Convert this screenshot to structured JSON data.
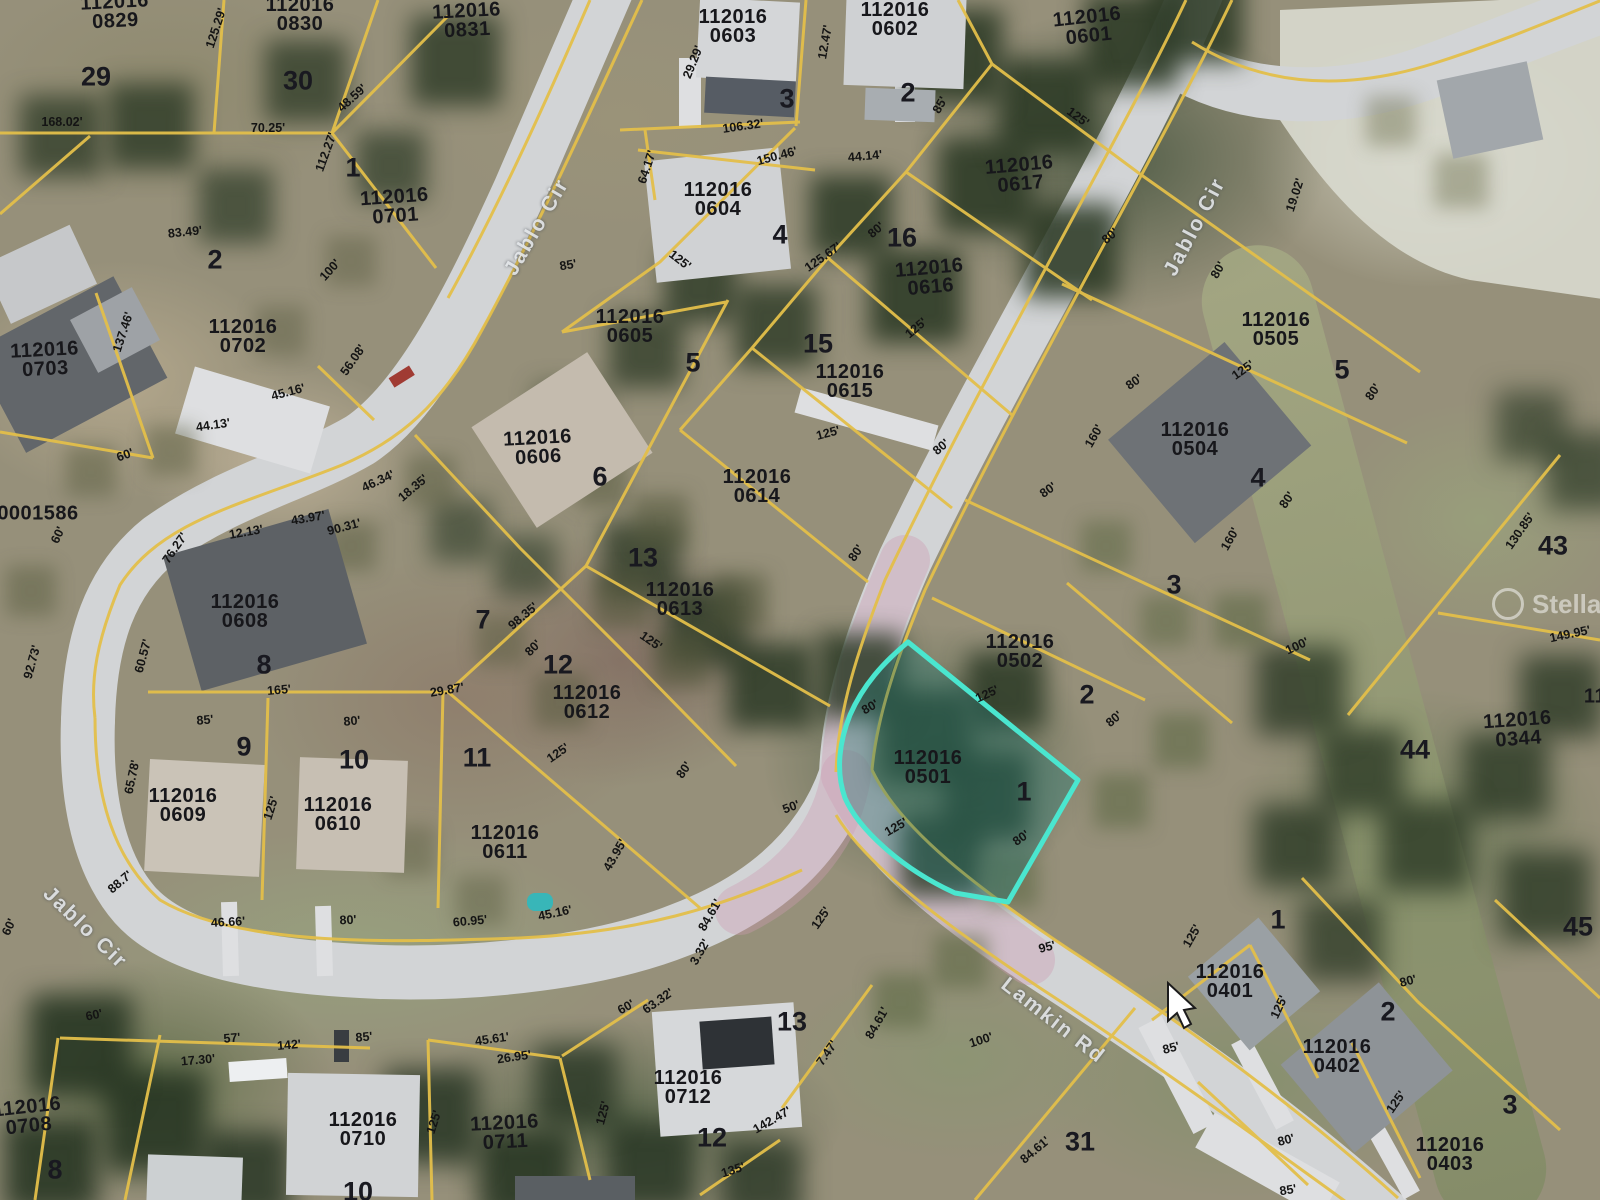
{
  "map": {
    "watermark": {
      "text": "Stellar MLS"
    },
    "highlight": {
      "parcel_id": "112016 0501",
      "color": "#4ae6cf"
    },
    "colors": {
      "parcel_line": "#e3bf4a",
      "road": "#d2d4d6",
      "highlight_fill": "rgba(38,120,115,0.4)"
    },
    "streets": [
      {
        "text": "Jablo Cir",
        "x": 537,
        "y": 227,
        "rot": -60
      },
      {
        "text": "Jablo Cir",
        "x": 1195,
        "y": 227,
        "rot": -62
      },
      {
        "text": "Jablo Cir",
        "x": 85,
        "y": 928,
        "rot": 44
      },
      {
        "text": "Lamkin Rd",
        "x": 1053,
        "y": 1021,
        "rot": 38
      }
    ],
    "parcel_labels": [
      {
        "text": "112016\n0829",
        "x": 115,
        "y": 12,
        "rot": -3
      },
      {
        "text": "112016\n0830",
        "x": 300,
        "y": 15,
        "rot": 0
      },
      {
        "text": "112016\n0831",
        "x": 467,
        "y": 21,
        "rot": -3
      },
      {
        "text": "112016\n0701",
        "x": 395,
        "y": 207,
        "rot": -4
      },
      {
        "text": "112016\n0702",
        "x": 243,
        "y": 337,
        "rot": 0
      },
      {
        "text": "112016\n0703",
        "x": 45,
        "y": 360,
        "rot": -3
      },
      {
        "text": "0001586",
        "x": 38,
        "y": 514,
        "rot": 0
      },
      {
        "text": "112016\n0603",
        "x": 733,
        "y": 27,
        "rot": 0
      },
      {
        "text": "112016\n0602",
        "x": 895,
        "y": 20,
        "rot": 0
      },
      {
        "text": "112016\n0601",
        "x": 1088,
        "y": 27,
        "rot": -6
      },
      {
        "text": "112016\n0604",
        "x": 718,
        "y": 200,
        "rot": 0
      },
      {
        "text": "112016\n0605",
        "x": 630,
        "y": 327,
        "rot": 0
      },
      {
        "text": "112016\n0606",
        "x": 538,
        "y": 448,
        "rot": -3
      },
      {
        "text": "112016\n0608",
        "x": 245,
        "y": 612,
        "rot": 0
      },
      {
        "text": "112016\n0609",
        "x": 183,
        "y": 806,
        "rot": 0
      },
      {
        "text": "112016\n0610",
        "x": 338,
        "y": 815,
        "rot": 0
      },
      {
        "text": "112016\n0611",
        "x": 505,
        "y": 843,
        "rot": 0
      },
      {
        "text": "112016\n0612",
        "x": 587,
        "y": 703,
        "rot": 0
      },
      {
        "text": "112016\n0613",
        "x": 680,
        "y": 600,
        "rot": 0
      },
      {
        "text": "112016\n0614",
        "x": 757,
        "y": 487,
        "rot": 0
      },
      {
        "text": "112016\n0615",
        "x": 850,
        "y": 382,
        "rot": 0
      },
      {
        "text": "112016\n0616",
        "x": 930,
        "y": 278,
        "rot": -5
      },
      {
        "text": "112016\n0617",
        "x": 1020,
        "y": 175,
        "rot": -5
      },
      {
        "text": "112016\n0504",
        "x": 1195,
        "y": 440,
        "rot": 0
      },
      {
        "text": "112016\n0505",
        "x": 1276,
        "y": 330,
        "rot": 0
      },
      {
        "text": "112016\n0502",
        "x": 1020,
        "y": 652,
        "rot": 0
      },
      {
        "text": "112016\n0501",
        "x": 928,
        "y": 768,
        "rot": 0
      },
      {
        "text": "112016\n0401",
        "x": 1230,
        "y": 982,
        "rot": 0
      },
      {
        "text": "112016\n0402",
        "x": 1337,
        "y": 1057,
        "rot": 0
      },
      {
        "text": "112016\n0403",
        "x": 1450,
        "y": 1155,
        "rot": 0
      },
      {
        "text": "112016\n0344",
        "x": 1518,
        "y": 730,
        "rot": -4
      },
      {
        "text": "112016\n0708",
        "x": 28,
        "y": 1117,
        "rot": -6
      },
      {
        "text": "112016\n0710",
        "x": 363,
        "y": 1130,
        "rot": 0
      },
      {
        "text": "112016\n0711",
        "x": 505,
        "y": 1133,
        "rot": -3
      },
      {
        "text": "112016\n0712",
        "x": 688,
        "y": 1088,
        "rot": 0
      },
      {
        "text": "11",
        "x": 1595,
        "y": 697,
        "rot": 0
      }
    ],
    "lot_numbers": [
      {
        "text": "29",
        "x": 96,
        "y": 77,
        "rot": 0
      },
      {
        "text": "30",
        "x": 298,
        "y": 81,
        "rot": 0
      },
      {
        "text": "1",
        "x": 353,
        "y": 168,
        "rot": 0
      },
      {
        "text": "2",
        "x": 215,
        "y": 260,
        "rot": 0
      },
      {
        "text": "3",
        "x": 787,
        "y": 99,
        "rot": 0
      },
      {
        "text": "2",
        "x": 908,
        "y": 93,
        "rot": 0
      },
      {
        "text": "4",
        "x": 780,
        "y": 235,
        "rot": 0
      },
      {
        "text": "5",
        "x": 693,
        "y": 363,
        "rot": 0
      },
      {
        "text": "6",
        "x": 600,
        "y": 477,
        "rot": 0
      },
      {
        "text": "16",
        "x": 902,
        "y": 238,
        "rot": 0
      },
      {
        "text": "15",
        "x": 818,
        "y": 344,
        "rot": 0
      },
      {
        "text": "13",
        "x": 643,
        "y": 558,
        "rot": 0
      },
      {
        "text": "4",
        "x": 1258,
        "y": 478,
        "rot": 0
      },
      {
        "text": "5",
        "x": 1342,
        "y": 370,
        "rot": 0
      },
      {
        "text": "3",
        "x": 1174,
        "y": 585,
        "rot": 0
      },
      {
        "text": "2",
        "x": 1087,
        "y": 695,
        "rot": 0
      },
      {
        "text": "1",
        "x": 1024,
        "y": 792,
        "rot": 0
      },
      {
        "text": "8",
        "x": 264,
        "y": 665,
        "rot": 0
      },
      {
        "text": "9",
        "x": 244,
        "y": 747,
        "rot": 0
      },
      {
        "text": "10",
        "x": 354,
        "y": 760,
        "rot": 0
      },
      {
        "text": "7",
        "x": 483,
        "y": 620,
        "rot": 0
      },
      {
        "text": "12",
        "x": 558,
        "y": 665,
        "rot": 0
      },
      {
        "text": "11",
        "x": 477,
        "y": 758,
        "rot": 0
      },
      {
        "text": "44",
        "x": 1415,
        "y": 750,
        "rot": 0
      },
      {
        "text": "43",
        "x": 1553,
        "y": 546,
        "rot": 0
      },
      {
        "text": "31",
        "x": 1080,
        "y": 1142,
        "rot": 0
      },
      {
        "text": "12",
        "x": 712,
        "y": 1138,
        "rot": 0
      },
      {
        "text": "13",
        "x": 792,
        "y": 1022,
        "rot": 0
      },
      {
        "text": "10",
        "x": 358,
        "y": 1192,
        "rot": 0
      },
      {
        "text": "8",
        "x": 55,
        "y": 1170,
        "rot": 0
      },
      {
        "text": "2",
        "x": 1388,
        "y": 1012,
        "rot": 0
      },
      {
        "text": "1",
        "x": 1278,
        "y": 920,
        "rot": 0
      },
      {
        "text": "3",
        "x": 1510,
        "y": 1105,
        "rot": 0
      },
      {
        "text": "45",
        "x": 1578,
        "y": 927,
        "rot": 0
      }
    ],
    "dimensions": [
      {
        "text": "168.02'",
        "x": 62,
        "y": 122,
        "rot": 0
      },
      {
        "text": "70.25'",
        "x": 268,
        "y": 128,
        "rot": 0
      },
      {
        "text": "125.29'",
        "x": 216,
        "y": 28,
        "rot": -72
      },
      {
        "text": "48.59'",
        "x": 352,
        "y": 98,
        "rot": -42
      },
      {
        "text": "112.27'",
        "x": 326,
        "y": 152,
        "rot": -70
      },
      {
        "text": "83.49'",
        "x": 185,
        "y": 232,
        "rot": -6
      },
      {
        "text": "100'",
        "x": 330,
        "y": 270,
        "rot": -48
      },
      {
        "text": "137.46'",
        "x": 123,
        "y": 332,
        "rot": -72
      },
      {
        "text": "56.08'",
        "x": 353,
        "y": 360,
        "rot": -55
      },
      {
        "text": "45.16'",
        "x": 288,
        "y": 392,
        "rot": -15
      },
      {
        "text": "44.13'",
        "x": 213,
        "y": 425,
        "rot": -8
      },
      {
        "text": "60'",
        "x": 125,
        "y": 455,
        "rot": -20
      },
      {
        "text": "60'",
        "x": 58,
        "y": 535,
        "rot": -65
      },
      {
        "text": "46.34'",
        "x": 378,
        "y": 481,
        "rot": -25
      },
      {
        "text": "12.13'",
        "x": 246,
        "y": 532,
        "rot": -10
      },
      {
        "text": "76.27'",
        "x": 175,
        "y": 548,
        "rot": -55
      },
      {
        "text": "43.97'",
        "x": 308,
        "y": 518,
        "rot": -10
      },
      {
        "text": "90.31'",
        "x": 344,
        "y": 527,
        "rot": -15
      },
      {
        "text": "18.35'",
        "x": 413,
        "y": 488,
        "rot": -40
      },
      {
        "text": "85'",
        "x": 568,
        "y": 265,
        "rot": -10
      },
      {
        "text": "125'",
        "x": 680,
        "y": 260,
        "rot": 38
      },
      {
        "text": "106.32'",
        "x": 743,
        "y": 126,
        "rot": -8
      },
      {
        "text": "150.46'",
        "x": 777,
        "y": 156,
        "rot": -15
      },
      {
        "text": "64.17'",
        "x": 647,
        "y": 167,
        "rot": -72
      },
      {
        "text": "29.29'",
        "x": 693,
        "y": 62,
        "rot": -68
      },
      {
        "text": "12.47'",
        "x": 825,
        "y": 42,
        "rot": -80
      },
      {
        "text": "44.14'",
        "x": 865,
        "y": 156,
        "rot": -5
      },
      {
        "text": "125'",
        "x": 1078,
        "y": 117,
        "rot": 36
      },
      {
        "text": "85'",
        "x": 940,
        "y": 105,
        "rot": -60
      },
      {
        "text": "125.67'",
        "x": 823,
        "y": 257,
        "rot": -35
      },
      {
        "text": "80'",
        "x": 876,
        "y": 230,
        "rot": -40
      },
      {
        "text": "125'",
        "x": 916,
        "y": 328,
        "rot": -40
      },
      {
        "text": "80'",
        "x": 941,
        "y": 447,
        "rot": -40
      },
      {
        "text": "125'",
        "x": 828,
        "y": 433,
        "rot": -15
      },
      {
        "text": "80'",
        "x": 856,
        "y": 553,
        "rot": -55
      },
      {
        "text": "160'",
        "x": 1094,
        "y": 436,
        "rot": -60
      },
      {
        "text": "80'",
        "x": 1134,
        "y": 382,
        "rot": -35
      },
      {
        "text": "80'",
        "x": 1048,
        "y": 490,
        "rot": -35
      },
      {
        "text": "80'",
        "x": 1110,
        "y": 236,
        "rot": -40
      },
      {
        "text": "19.02'",
        "x": 1295,
        "y": 195,
        "rot": -72
      },
      {
        "text": "80'",
        "x": 1218,
        "y": 270,
        "rot": -60
      },
      {
        "text": "125'",
        "x": 1243,
        "y": 370,
        "rot": -35
      },
      {
        "text": "80'",
        "x": 1373,
        "y": 392,
        "rot": -55
      },
      {
        "text": "80'",
        "x": 1287,
        "y": 500,
        "rot": -55
      },
      {
        "text": "160'",
        "x": 1230,
        "y": 539,
        "rot": -60
      },
      {
        "text": "130.85'",
        "x": 1520,
        "y": 531,
        "rot": -55
      },
      {
        "text": "149.95'",
        "x": 1570,
        "y": 634,
        "rot": -12
      },
      {
        "text": "100'",
        "x": 1297,
        "y": 646,
        "rot": -25
      },
      {
        "text": "92.73'",
        "x": 32,
        "y": 662,
        "rot": -75
      },
      {
        "text": "60.57'",
        "x": 143,
        "y": 656,
        "rot": -75
      },
      {
        "text": "165'",
        "x": 279,
        "y": 690,
        "rot": -5
      },
      {
        "text": "85'",
        "x": 205,
        "y": 720,
        "rot": -5
      },
      {
        "text": "80'",
        "x": 352,
        "y": 721,
        "rot": -5
      },
      {
        "text": "65.78'",
        "x": 132,
        "y": 777,
        "rot": -78
      },
      {
        "text": "125'",
        "x": 271,
        "y": 808,
        "rot": -72
      },
      {
        "text": "88.7'",
        "x": 120,
        "y": 882,
        "rot": -40
      },
      {
        "text": "98.35'",
        "x": 523,
        "y": 616,
        "rot": -40
      },
      {
        "text": "80'",
        "x": 533,
        "y": 648,
        "rot": -45
      },
      {
        "text": "29.87'",
        "x": 447,
        "y": 690,
        "rot": -10
      },
      {
        "text": "125'",
        "x": 651,
        "y": 641,
        "rot": 35
      },
      {
        "text": "125'",
        "x": 558,
        "y": 753,
        "rot": -35
      },
      {
        "text": "80'",
        "x": 684,
        "y": 770,
        "rot": -55
      },
      {
        "text": "43.95'",
        "x": 615,
        "y": 855,
        "rot": -60
      },
      {
        "text": "50'",
        "x": 791,
        "y": 807,
        "rot": -20
      },
      {
        "text": "80'",
        "x": 870,
        "y": 707,
        "rot": -30
      },
      {
        "text": "125'",
        "x": 987,
        "y": 694,
        "rot": -25
      },
      {
        "text": "80'",
        "x": 1114,
        "y": 719,
        "rot": -40
      },
      {
        "text": "125'",
        "x": 896,
        "y": 827,
        "rot": -30
      },
      {
        "text": "80'",
        "x": 1021,
        "y": 838,
        "rot": -35
      },
      {
        "text": "46.66'",
        "x": 228,
        "y": 922,
        "rot": -3
      },
      {
        "text": "80'",
        "x": 348,
        "y": 920,
        "rot": -3
      },
      {
        "text": "60'",
        "x": 9,
        "y": 927,
        "rot": -65
      },
      {
        "text": "60'",
        "x": 94,
        "y": 1015,
        "rot": -12
      },
      {
        "text": "57'",
        "x": 232,
        "y": 1038,
        "rot": -5
      },
      {
        "text": "142'",
        "x": 289,
        "y": 1045,
        "rot": -5
      },
      {
        "text": "17.30'",
        "x": 198,
        "y": 1060,
        "rot": -5
      },
      {
        "text": "85'",
        "x": 364,
        "y": 1037,
        "rot": -5
      },
      {
        "text": "60.95'",
        "x": 470,
        "y": 921,
        "rot": -5
      },
      {
        "text": "45.16'",
        "x": 555,
        "y": 913,
        "rot": -12
      },
      {
        "text": "45.61'",
        "x": 492,
        "y": 1039,
        "rot": -8
      },
      {
        "text": "26.95'",
        "x": 514,
        "y": 1057,
        "rot": -8
      },
      {
        "text": "63.32'",
        "x": 658,
        "y": 1001,
        "rot": -35
      },
      {
        "text": "60'",
        "x": 626,
        "y": 1007,
        "rot": -30
      },
      {
        "text": "3.32'",
        "x": 700,
        "y": 952,
        "rot": -60
      },
      {
        "text": "84.61'",
        "x": 710,
        "y": 915,
        "rot": -60
      },
      {
        "text": "125'",
        "x": 434,
        "y": 1122,
        "rot": -72
      },
      {
        "text": "125'",
        "x": 603,
        "y": 1113,
        "rot": -75
      },
      {
        "text": "135'",
        "x": 733,
        "y": 1170,
        "rot": -18
      },
      {
        "text": "142.47'",
        "x": 772,
        "y": 1120,
        "rot": -30
      },
      {
        "text": "95'",
        "x": 1047,
        "y": 947,
        "rot": -15
      },
      {
        "text": "100'",
        "x": 981,
        "y": 1040,
        "rot": -18
      },
      {
        "text": "84.61'",
        "x": 1035,
        "y": 1150,
        "rot": -40
      },
      {
        "text": "7.47'",
        "x": 827,
        "y": 1053,
        "rot": -55
      },
      {
        "text": "84.61'",
        "x": 877,
        "y": 1023,
        "rot": -60
      },
      {
        "text": "125'",
        "x": 821,
        "y": 918,
        "rot": -55
      },
      {
        "text": "125'",
        "x": 1192,
        "y": 936,
        "rot": -60
      },
      {
        "text": "85'",
        "x": 1171,
        "y": 1048,
        "rot": -15
      },
      {
        "text": "125'",
        "x": 1279,
        "y": 1007,
        "rot": -65
      },
      {
        "text": "80'",
        "x": 1408,
        "y": 981,
        "rot": -15
      },
      {
        "text": "125'",
        "x": 1396,
        "y": 1102,
        "rot": -55
      },
      {
        "text": "80'",
        "x": 1286,
        "y": 1140,
        "rot": -15
      },
      {
        "text": "85'",
        "x": 1288,
        "y": 1190,
        "rot": -10
      }
    ]
  }
}
